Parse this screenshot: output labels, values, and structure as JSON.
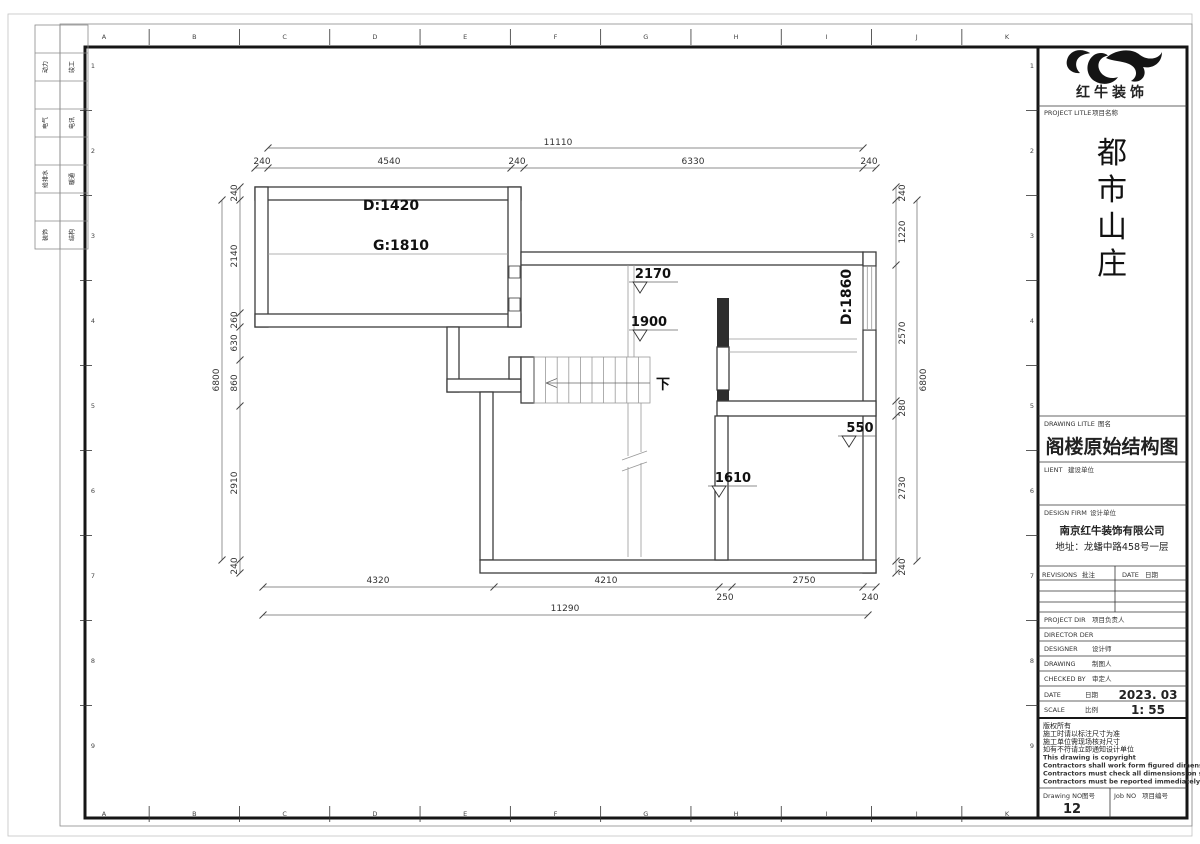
{
  "sheet": {
    "top_letters": [
      "A",
      "B",
      "C",
      "D",
      "E",
      "F",
      "G",
      "H",
      "I",
      "J",
      "K"
    ],
    "bottom_letters": [
      "A",
      "B",
      "C",
      "D",
      "E",
      "F",
      "G",
      "H",
      "I",
      "J",
      "K"
    ],
    "side_numbers": [
      "1",
      "2",
      "3",
      "4",
      "5",
      "6",
      "7",
      "8",
      "9"
    ],
    "discipline_table_rows": [
      [
        "动力",
        "竣工"
      ],
      [
        "电气",
        "电讯"
      ],
      [
        "给排水",
        "暖通"
      ],
      [
        "装饰",
        "结构"
      ]
    ]
  },
  "plan": {
    "labels": {
      "d1420": "D:1420",
      "g1810": "G:1810",
      "d1860": "D:1860",
      "stair_down": "下"
    },
    "elevation_markers": [
      "2170",
      "1900",
      "550",
      "1610"
    ],
    "dims": {
      "top_total": "11110",
      "top_segments": [
        "240",
        "4540",
        "240",
        "6330",
        "240"
      ],
      "bottom_segments": [
        "4320",
        "4210",
        "2750"
      ],
      "bottom_sub": [
        "250",
        "240"
      ],
      "bottom_total": "11290",
      "left_segments": [
        "240",
        "2140",
        "260",
        "630",
        "860",
        "2910",
        "240"
      ],
      "left_total": "6800",
      "right_segments": [
        "240",
        "1220",
        "2570",
        "280",
        "2730",
        "240"
      ],
      "right_total": "6800"
    }
  },
  "title_block": {
    "brand": "红牛装饰",
    "project_label_en": "PROJECT LITLE",
    "project_label_cn": "项目名称",
    "project_name": "都市山庄",
    "drawing_label_en": "DRAWING LITLE",
    "drawing_label_cn": "图名",
    "drawing_name": "阁楼原始结构图",
    "client_label_en": "LIENT",
    "client_label_cn": "建设单位",
    "firm_label_en": "DESIGN FIRM",
    "firm_label_cn": "设计单位",
    "firm_name": "南京红牛装饰有限公司",
    "firm_address": "地址：龙蟠中路458号一层",
    "revisions_label_en": "REVISIONS",
    "revisions_label_cn": "批注",
    "date_col_en": "DATE",
    "date_col_cn": "日期",
    "rows": {
      "project_dir": {
        "en": "PROJECT DIR",
        "cn": "项目负责人"
      },
      "director": {
        "en": "DIRECTOR DER",
        "cn": ""
      },
      "designer": {
        "en": "DESIGNER",
        "cn": "设计师"
      },
      "drawing": {
        "en": "DRAWING",
        "cn": "制图人"
      },
      "checked": {
        "en": "CHECKED BY",
        "cn": "审定人"
      },
      "date": {
        "en": "DATE",
        "cn": "日期",
        "value": "2023. 03"
      },
      "scale": {
        "en": "SCALE",
        "cn": "比例",
        "value": "1: 55"
      }
    },
    "copyright_lines": [
      "版权所有",
      "施工时请以标注尺寸为准",
      "施工单位需现场核对尺寸",
      "如有不符请立即通知设计单位",
      "This drawing is copyright",
      "Contractors shall work form figured dimensions only",
      "Contractors must check all dimensions on site",
      "Contractors must be reported immediately to architects"
    ],
    "drawing_no_label_en": "Drawing NO",
    "drawing_no_label_cn": "图号",
    "drawing_no": "12",
    "job_no_label_en": "Job NO",
    "job_no_label_cn": "项目编号"
  }
}
